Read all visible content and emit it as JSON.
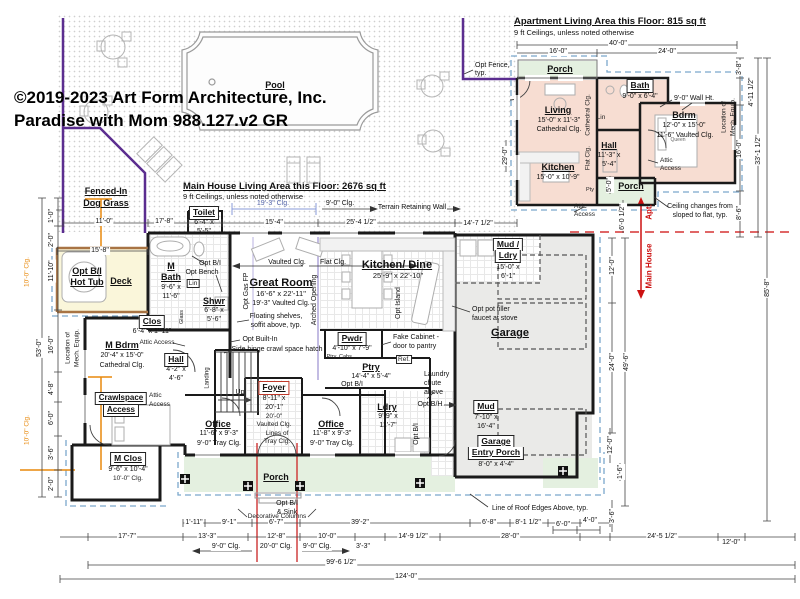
{
  "title": {
    "copyright_line1": "©2019-2023 Art Form Architecture, Inc.",
    "copyright_line2": "Paradise with Mom 988.127.v2 GR"
  },
  "headers": {
    "main_area": "Main House Living Area this Floor: 2676 sq ft",
    "main_ceilings": "9 ft Ceilings, unless noted otherwise",
    "apt_area": "Apartment Living Area this Floor:  815 sq ft",
    "apt_ceilings": "9 ft Ceilings, unless noted otherwise"
  },
  "site": {
    "pool": "Pool",
    "dog_grass_1": "Fenced-In",
    "dog_grass_2": "Dog Grass",
    "opt_fence_1": "Opt Fence,",
    "opt_fence_2": "typ.",
    "terrain_wall": "Terrain Retaining Wall"
  },
  "rooms": {
    "toilet": {
      "n": "Toilet",
      "s1": "6'-4\" x",
      "s2": "5'-5\""
    },
    "deck": {
      "n": "Deck"
    },
    "hot_tub": {
      "n1": "Opt B/I",
      "n2": "Hot Tub"
    },
    "m_bath": {
      "n1": "M",
      "n2": "Bath",
      "s1": "9'-6\" x",
      "s2": "11'-6\""
    },
    "shwr": {
      "n": "Shwr",
      "s1": "6'-8\" x",
      "s2": "5'-6\""
    },
    "lin": {
      "n": "Lin"
    },
    "clos": {
      "n": "Clos",
      "s": "6'-4\" x 1'-11\""
    },
    "m_bdrm": {
      "n": "M Bdrm",
      "s": "20'-4\" x 15'-0\"",
      "c": "Cathedral Clg."
    },
    "hall": {
      "n": "Hall",
      "s1": "4'-2\" x",
      "s2": "4'-6\""
    },
    "crawlspace": {
      "n1": "Crawlspace",
      "n2": "Access"
    },
    "m_clos": {
      "n": "M Clos",
      "s": "9'-6\" x 10'-4\"",
      "c": "10'-0\" Clg."
    },
    "great_room": {
      "n": "Great Room",
      "s": "16'-6\" x 22'-11\"",
      "c": "19'-3\" Vaulted Clg."
    },
    "kitchen_dine": {
      "n": "Kitchen/ Dine",
      "s": "25'-9\" x 22'-10\""
    },
    "pwdr": {
      "n": "Pwdr",
      "s": "4'-10\" x 7'-9\""
    },
    "ptry": {
      "n": "Ptry",
      "s": "14'-4\" x 5'-4\""
    },
    "foyer": {
      "n": "Foyer",
      "s1": "8'-11\" x",
      "s2": "20'-1\"",
      "c1": "20'-0\"",
      "c2": "Vaulted Clg."
    },
    "office_l": {
      "n": "Office",
      "s": "11'-6\" x 9'-3\"",
      "c": "9'-0\" Tray Clg."
    },
    "office_r": {
      "n": "Office",
      "s": "11'-8\" x 9'-3\"",
      "c": "9'-0\" Tray Clg."
    },
    "ldry": {
      "n": "Ldry",
      "s1": "9'-9\" x",
      "s2": "11'-7\""
    },
    "mud_ldry": {
      "n1": "Mud /",
      "n2": "Ldry",
      "s1": "15'-0\" x",
      "s2": "6'-1\""
    },
    "garage": {
      "n": "Garage"
    },
    "mud": {
      "n": "Mud",
      "s1": "7'-10\" x",
      "s2": "16'-4\""
    },
    "garage_entry": {
      "n1": "Garage",
      "n2": "Entry Porch",
      "s": "8'-0\" x 4'-4\""
    },
    "porch": {
      "n": "Porch"
    }
  },
  "apt": {
    "porch_top": "Porch",
    "living": {
      "n": "Living",
      "s": "15'-0\" x 11'-3\"",
      "c": "Cathedral Clg."
    },
    "kitchen": {
      "n": "Kitchen",
      "s": "15'-0\" x 10'-9\""
    },
    "bath": {
      "n": "Bath",
      "s": "9'-0\" x 6'-4\""
    },
    "hall": {
      "n": "Hall",
      "s1": "11'-3\" x",
      "s2": "5'-4\""
    },
    "bdrm": {
      "n": "Bdrm",
      "s": "12'-0\" x 15'-0\"",
      "c": "11'-6\" Vaulted Clg."
    },
    "porch_side": "Porch",
    "lin": "Lin",
    "queen": "Queen",
    "wall_ht": "9'-0\" Wall Ht."
  },
  "ann": {
    "opt_bi_bath": "Opt B/I",
    "opt_bench": "Opt Bench",
    "glass": "Glass",
    "attic_access": "Attic Access",
    "attic_1": "Attic",
    "attic_2": "Access",
    "loc_mech_1": "Location of",
    "loc_mech_2": "Mech. Equip.",
    "opt_gas_fp": "Opt Gas FP",
    "arched_opening": "Arched Opening",
    "vaulted_clg": "Vaulted Clg.",
    "flat_clg": "Flat Clg.",
    "floating_1": "Floating shelves,",
    "floating_2": "soffit above, typ.",
    "opt_builtin": "Opt Built-In",
    "side_hinge": "Side hinge crawl space hatch",
    "opt_island": "Opt Island",
    "pot_filler_1": "Opt pot filler",
    "pot_filler_2": "faucet at stove",
    "fake_cab_1": "Fake Cabinet -",
    "fake_cab_2": "door to pantry",
    "ptry_cabs": "Ptry. Cabs.",
    "ref": "Ref.",
    "opt_bi": "Opt B/I",
    "laundry_1": "Laundry",
    "laundry_2": "chute",
    "laundry_3": "above",
    "opt_bh": "Opt B/H",
    "opt_bi_sink_1": "Opt B/I",
    "opt_bi_sink_2": "& Sink",
    "tray_1": "Lines of",
    "tray_2": "Tray Clg.",
    "dec_columns": "Decorative Columns",
    "roof_edges": "Line of Roof Edges Above, typ.",
    "ceiling_1": "Ceiling changes from",
    "ceiling_2": "sloped to flat, typ.",
    "up": "Up",
    "landing": "Landing",
    "pty": "Pty",
    "apt_arrow": "Apt.",
    "main_arrow": "Main House",
    "cathedral_v": "Cathedral Clg.",
    "flat_v": "Flat Clg.",
    "clg_19_3": "19'-3\" Clg.",
    "clg_9_0": "9'-0\" Clg.",
    "clg_10_0": "10'-0\" Clg."
  },
  "dims": {
    "top_apt": [
      "40'-0\"",
      "16'-0\"",
      "24'-0\""
    ],
    "top_main": [
      "11'-0\"",
      "17'-8\"",
      "15'-4\"",
      "25'-4 1/2\"",
      "14'-7 1/2\""
    ],
    "deck": "15'-8\"",
    "left": [
      "1'-0\"",
      "2'-0\"",
      "11'-10\"",
      "16'-0\"",
      "4'-8\"",
      "6'-0\"",
      "3'-6\"",
      "2'-0\""
    ],
    "left_total": "53'-0\"",
    "apt_left": "29'-0\"",
    "apt_porch_w": "5'-0\"",
    "apt_porch_h": "6'-0 1/2\"",
    "right": [
      "3'-8\"",
      "4'-11 1/2\"",
      "16'-0\"",
      "8'-6\""
    ],
    "right_total_apt": "33'-1 1/2\"",
    "right_total": "85'-8\"",
    "garage_right": [
      "12'-0\"",
      "24'-0\"",
      "49'-6\""
    ],
    "lower_right": [
      "12'-0\"",
      "1'-6\"",
      "3'-6\""
    ],
    "row_a": [
      "1'-11\"",
      "9'-1\"",
      "6'-7\"",
      "39'-2\"",
      "6'-8\"",
      "8'-1 1/2\"",
      "6'-0\"",
      "4'-0\""
    ],
    "row_b": [
      "17'-7\"",
      "13'-3\"",
      "12'-8\"",
      "10'-0\"",
      "14'-9 1/2\"",
      "28'-0\"",
      "24'-5 1/2\"",
      "12'-0\"",
      "3'-3\""
    ],
    "clg_row": [
      "9'-0\" Clg.",
      "20'-0\" Clg.",
      "9'-0\" Clg."
    ],
    "total_1": "99'-6 1/2\"",
    "total_2": "124'-0\""
  }
}
